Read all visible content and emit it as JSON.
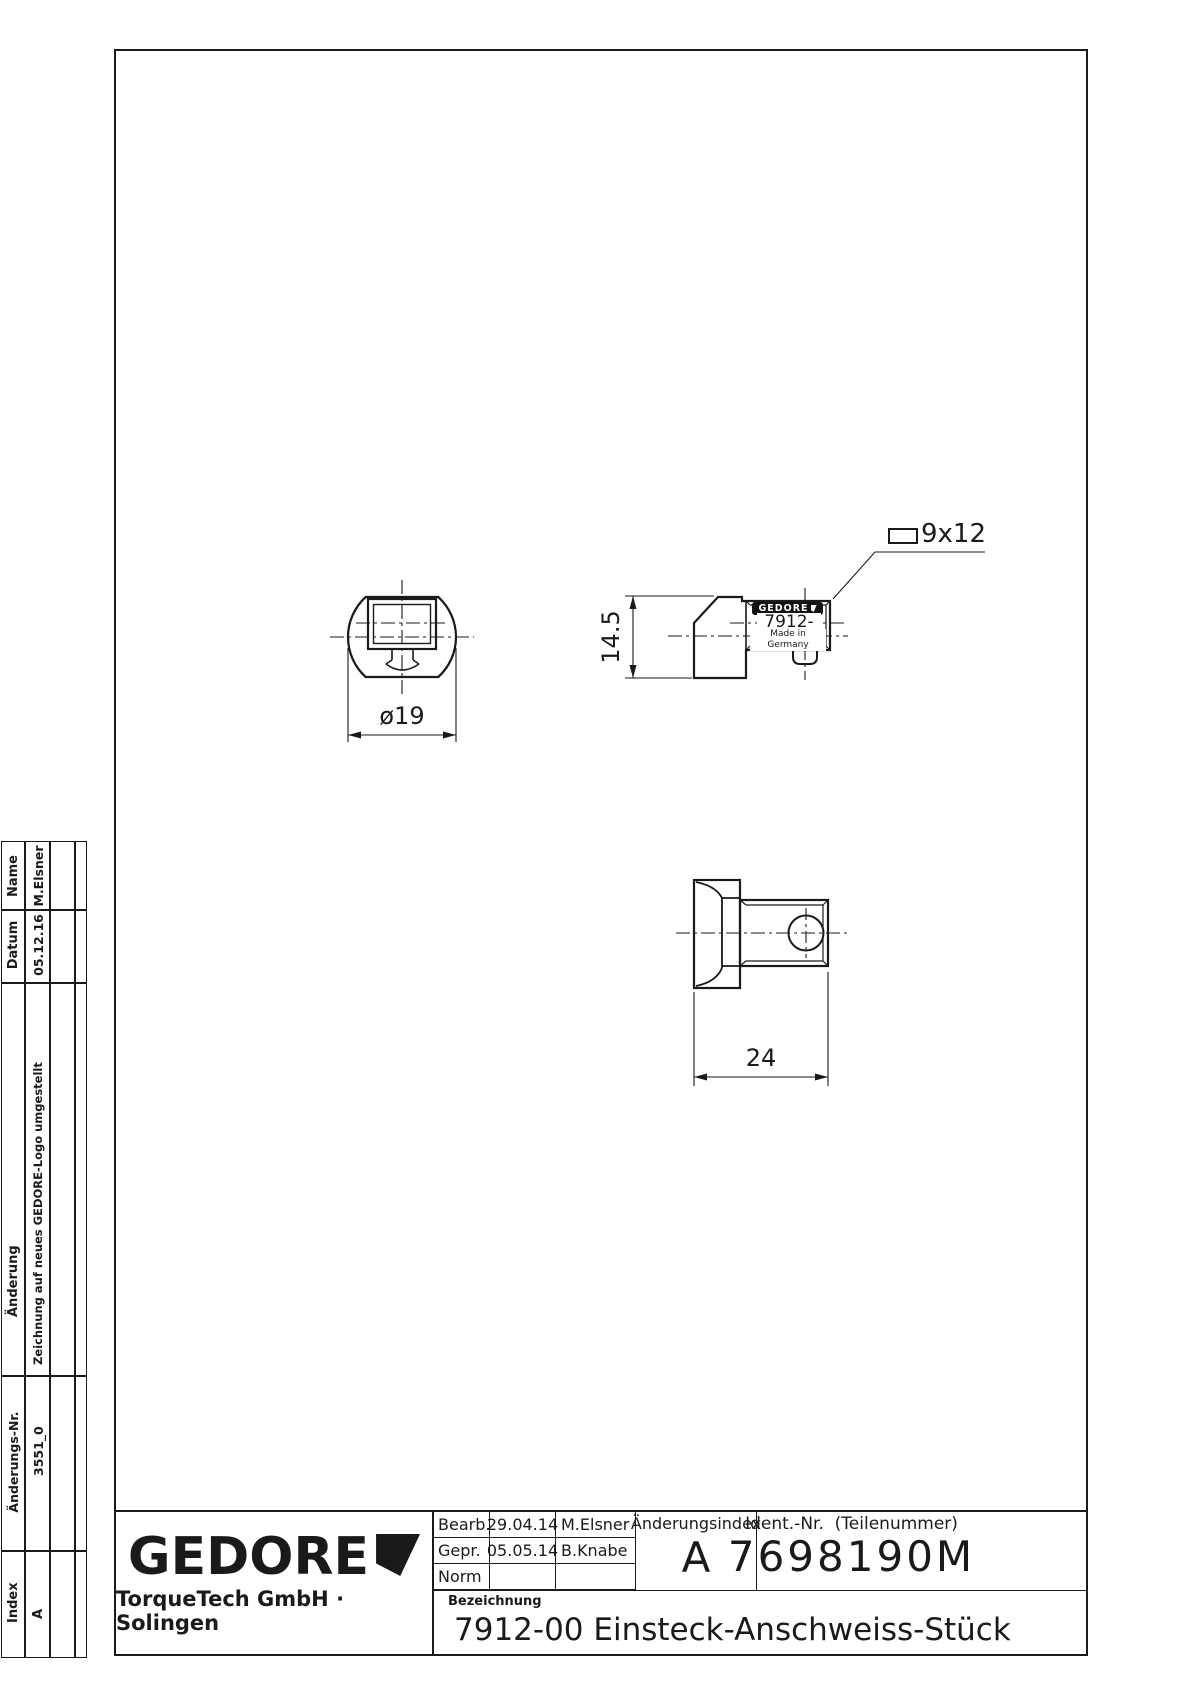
{
  "page": {
    "background": "#ffffff",
    "line_color": "#1a1a1a"
  },
  "views": {
    "front": {
      "dim_diameter": "ø19"
    },
    "side": {
      "dim_height": "14.5",
      "callout": "9x12",
      "brand": "GEDORE",
      "part_no": "7912-00",
      "origin": "Made in Germany"
    },
    "bottom": {
      "dim_width": "24"
    }
  },
  "revision_table": {
    "headers": {
      "name": "Name",
      "datum": "Datum",
      "aenderung": "Änderung",
      "aenderungs_nr": "Änderungs-Nr.",
      "index": "Index"
    },
    "entries": [
      {
        "name": "M.Elsner",
        "datum": "05.12.16",
        "aenderung": "Zeichnung auf neues GEDORE-Logo umgestellt",
        "aenderungs_nr": "3551_0",
        "index": "A"
      }
    ]
  },
  "title_block": {
    "logo": "GEDORE",
    "company": "TorqueTech GmbH · Solingen",
    "rows": [
      {
        "label": "Bearb.",
        "date": "29.04.14",
        "name": "M.Elsner"
      },
      {
        "label": "Gepr.",
        "date": "05.05.14",
        "name": "B.Knabe"
      },
      {
        "label": "Norm",
        "date": "",
        "name": ""
      }
    ],
    "aenderungsindex_label": "Änderungsindex",
    "aenderungsindex_value": "A",
    "ident_label": "Ident.-Nr.  (Teilenummer)",
    "ident_value": "7698190M",
    "bezeichnung_label": "Bezeichnung",
    "bezeichnung_value": "7912-00 Einsteck-Anschweiss-Stück"
  }
}
